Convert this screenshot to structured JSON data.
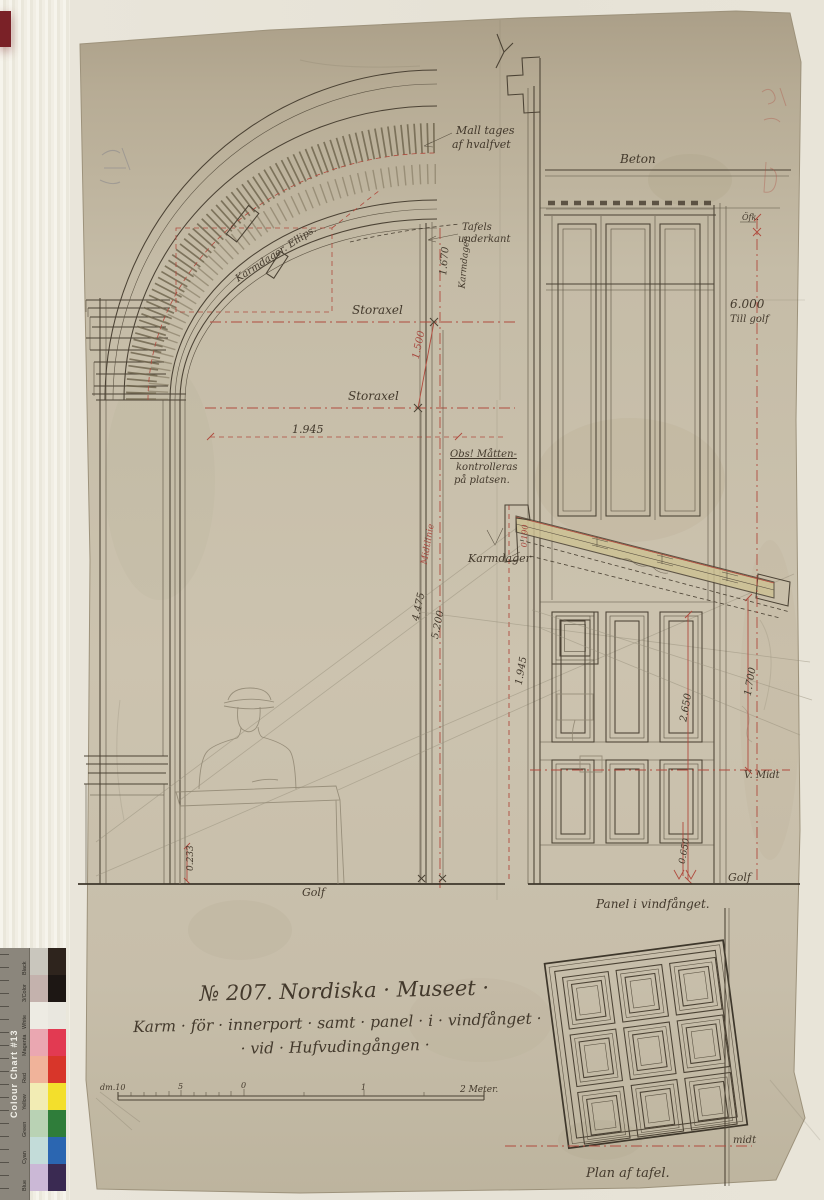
{
  "photo": {
    "backdrop_color": "#e9e5da",
    "paper_color": "#c8bfaa",
    "ink_color": "#4b4234",
    "red_ink_color": "#b04b3e",
    "pencil_color": "#8f8672",
    "archive_tab_color": "#7a2127",
    "color_chart": {
      "title": "Colour Chart #13",
      "rows": [
        {
          "label": "Black",
          "tint": "#c9c6bd",
          "full": "#2e241d"
        },
        {
          "label": "3/Color",
          "tint": "#c4b2ad",
          "full": "#1d1714"
        },
        {
          "label": "White",
          "tint": "#edebe3",
          "full": "#e9e7df"
        },
        {
          "label": "Magenta",
          "tint": "#eaa7b1",
          "full": "#e23a52"
        },
        {
          "label": "Red",
          "tint": "#f0b39a",
          "full": "#d8362a"
        },
        {
          "label": "Yellow",
          "tint": "#f2ecb4",
          "full": "#f3df2c"
        },
        {
          "label": "Green",
          "tint": "#b9d2b4",
          "full": "#2f7d3a"
        },
        {
          "label": "Cyan",
          "tint": "#c3dcd9",
          "full": "#2b66b1"
        },
        {
          "label": "Blue",
          "tint": "#cbb8d6",
          "full": "#3a2a52"
        }
      ]
    }
  },
  "title_block": {
    "drawing_number_title": "№ 207. Nordiska · Museet ·",
    "subtitle_line1": "Karm · för · innerport · samt · panel · i · vindfånget ·",
    "subtitle_line2": "· vid · Hufvudingången ·"
  },
  "scale_bar": {
    "left_label": "dm.10",
    "tick_5": "5",
    "tick_0": "0",
    "tick_1": "1",
    "right_label": "2 Meter."
  },
  "arch_section": {
    "mall_line1": "Mall tages",
    "mall_line2": "af hvalfvet",
    "tafels_line1": "Tafels",
    "tafels_line2": "underkant",
    "karmdager_ellips": "Karmdager. Ellips.",
    "storaxel_upper": "Storaxel",
    "storaxel_lower": "Storaxel",
    "dim_1500": "1.500",
    "dim_1670": "1.670",
    "karmdager_vertical": "Karmdager",
    "dim_1945": "1.945",
    "obs_line1": "Obs! Måtten-",
    "obs_line2": "kontrolleras",
    "obs_line3": "på platsen.",
    "midtlinie": "Midtlinie",
    "dim_4475": "4.475",
    "dim_5200": "5.200",
    "karmdager_mid": "Karmdager",
    "dim_0190": "0.190",
    "dim_0233": "0.233",
    "golf": "Golf"
  },
  "door_elevation": {
    "beton": "Beton",
    "ofk": "Öfk.",
    "dim_6000_line1": "6.000",
    "dim_6000_line2": "Till golf",
    "dim_1945": "1.945",
    "dim_2650": "2.650",
    "dim_1700": "1.700",
    "v_midt": "V. Midt",
    "dim_0650": "0.650",
    "golf": "Golf",
    "caption": "Panel i vindfånget."
  },
  "panel_plan": {
    "midt": "midt",
    "caption": "Plan af tafel."
  }
}
